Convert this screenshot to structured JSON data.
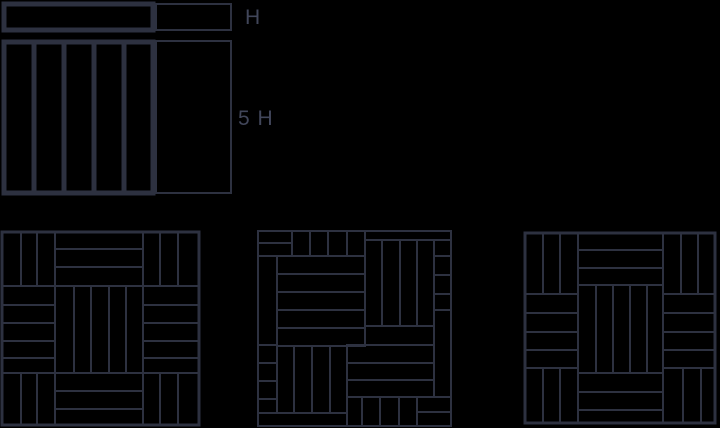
{
  "colors": {
    "background": "#000000",
    "line": "#2d3140",
    "label": "#41465a"
  },
  "plank_figure": {
    "h_label": "H",
    "five_h_label": "5 H",
    "horizontal_planks": 1,
    "vertical_planks": 5,
    "meaning": "one plank is H wide and 5 H long"
  },
  "patterns": {
    "left": {
      "name": "basketweave-3x3",
      "grid": [
        [
          "V3",
          "H3",
          "V3"
        ],
        [
          "H5",
          "V5",
          "H5"
        ],
        [
          "V3",
          "H3",
          "V3"
        ]
      ]
    },
    "middle": {
      "name": "pinwheel",
      "center_blocks": [
        "H5 top-left",
        "V4 top-right",
        "H4 bottom-right",
        "V4 bottom-left"
      ],
      "edge_fillers": [
        "2-strip corner blocks",
        "thin edge strips",
        "short edge pieces"
      ]
    },
    "right": {
      "name": "offset-basketweave-3x3",
      "grid": [
        [
          "V3",
          "H3",
          "V3"
        ],
        [
          "H4",
          "V5",
          "H4"
        ],
        [
          "V3",
          "H3",
          "V3"
        ]
      ],
      "note": "middle column shifted up relative to side columns"
    }
  }
}
